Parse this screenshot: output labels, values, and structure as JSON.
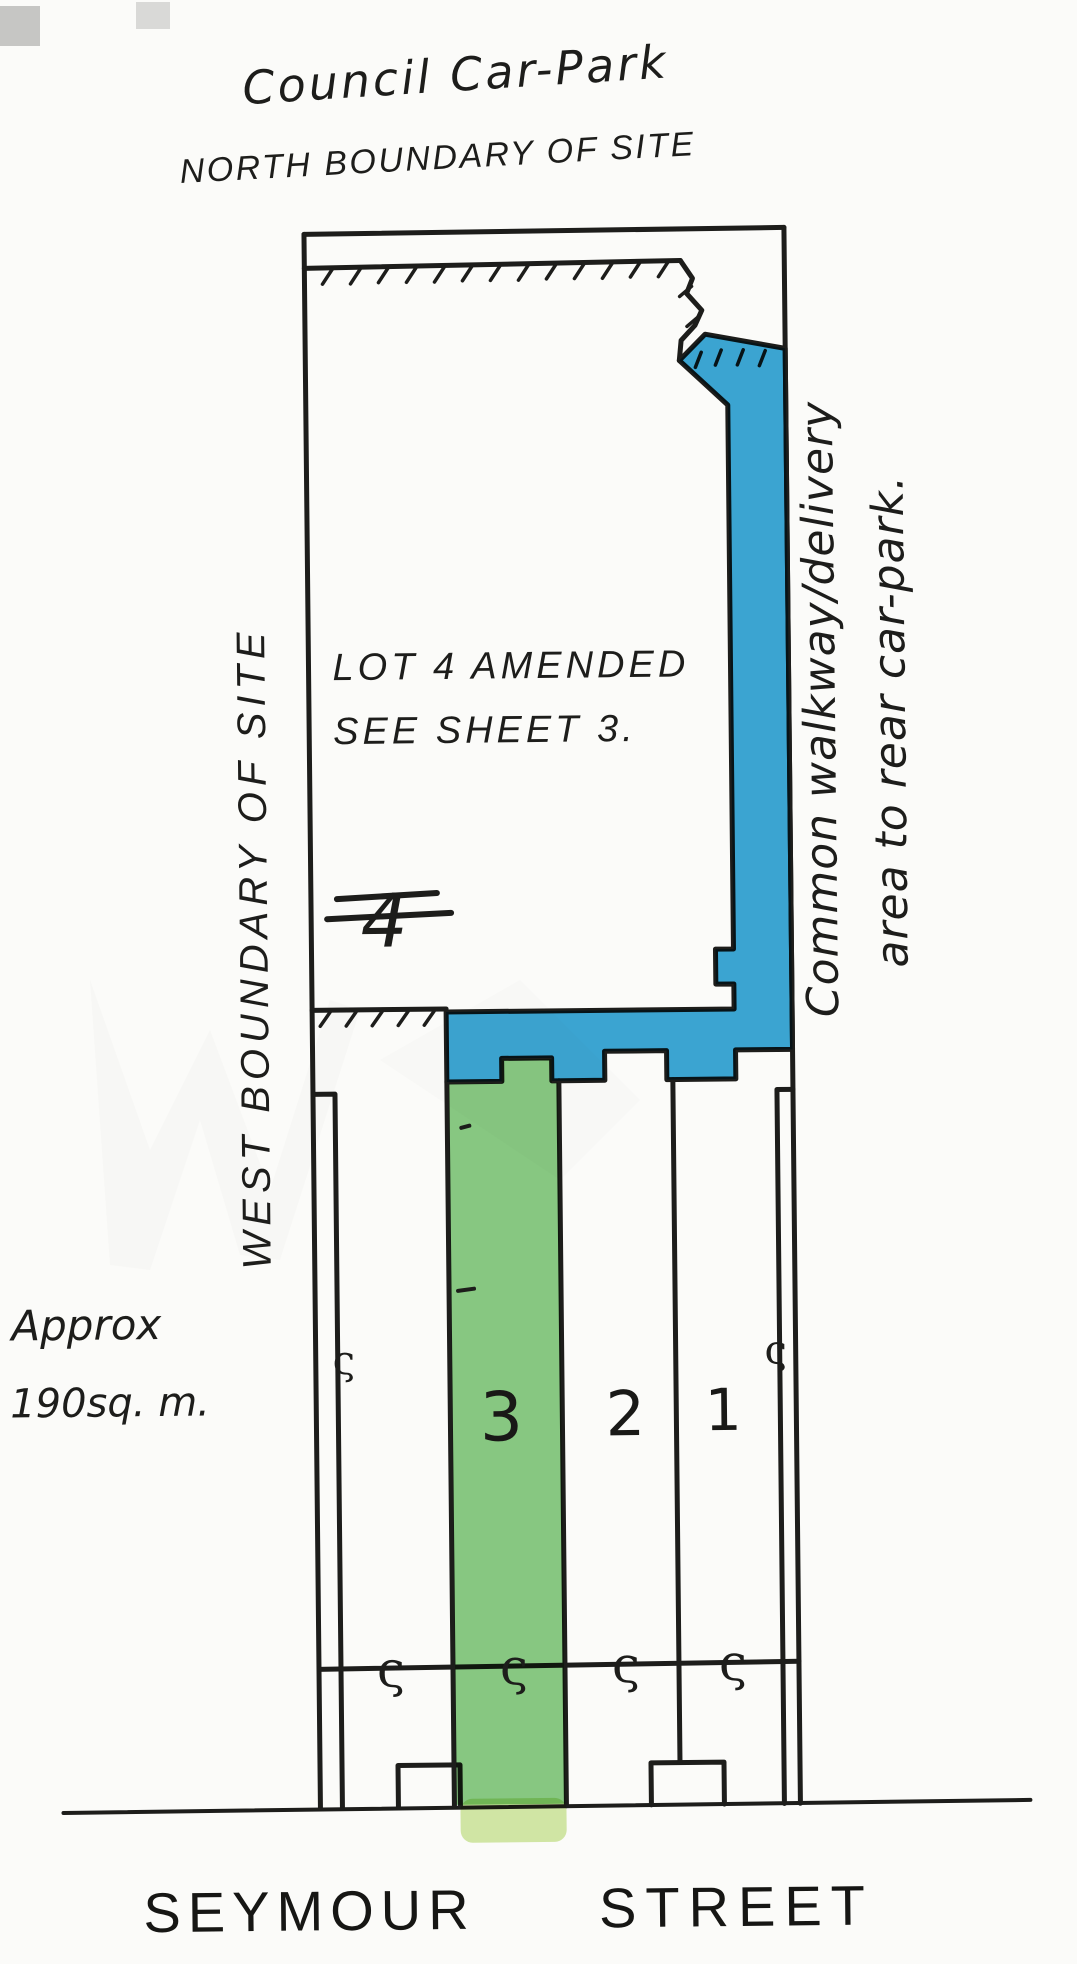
{
  "document": {
    "type": "hand-drawn site plan sketch",
    "sheet_note": "Lot 4 amended - see sheet 3"
  },
  "labels": {
    "title": "Council Car-Park",
    "north_boundary": "NORTH BOUNDARY OF SITE",
    "west_boundary": "WEST BOUNDARY OF SITE",
    "lot4_line1": "LOT 4 AMENDED",
    "lot4_line2": "SEE SHEET 3.",
    "lot4_mark": "4",
    "walkway_line1": "Common walkway/delivery",
    "walkway_line2": "area to rear car-park.",
    "approx_line1": "Approx",
    "approx_line2": "190sq. m.",
    "street_word1": "SEYMOUR",
    "street_word2": "STREET"
  },
  "lots": [
    {
      "number": "3",
      "highlighted": true
    },
    {
      "number": "2",
      "highlighted": false
    },
    {
      "number": "1",
      "highlighted": false
    }
  ],
  "marks": {
    "hook": "ς"
  },
  "colors": {
    "walkway_blue": "#2b9fd3",
    "lot_green": "#7cc477",
    "lot_green_light": "#cfe79e",
    "ink": "#1d1d1b",
    "paper": "#fbfbf9"
  }
}
